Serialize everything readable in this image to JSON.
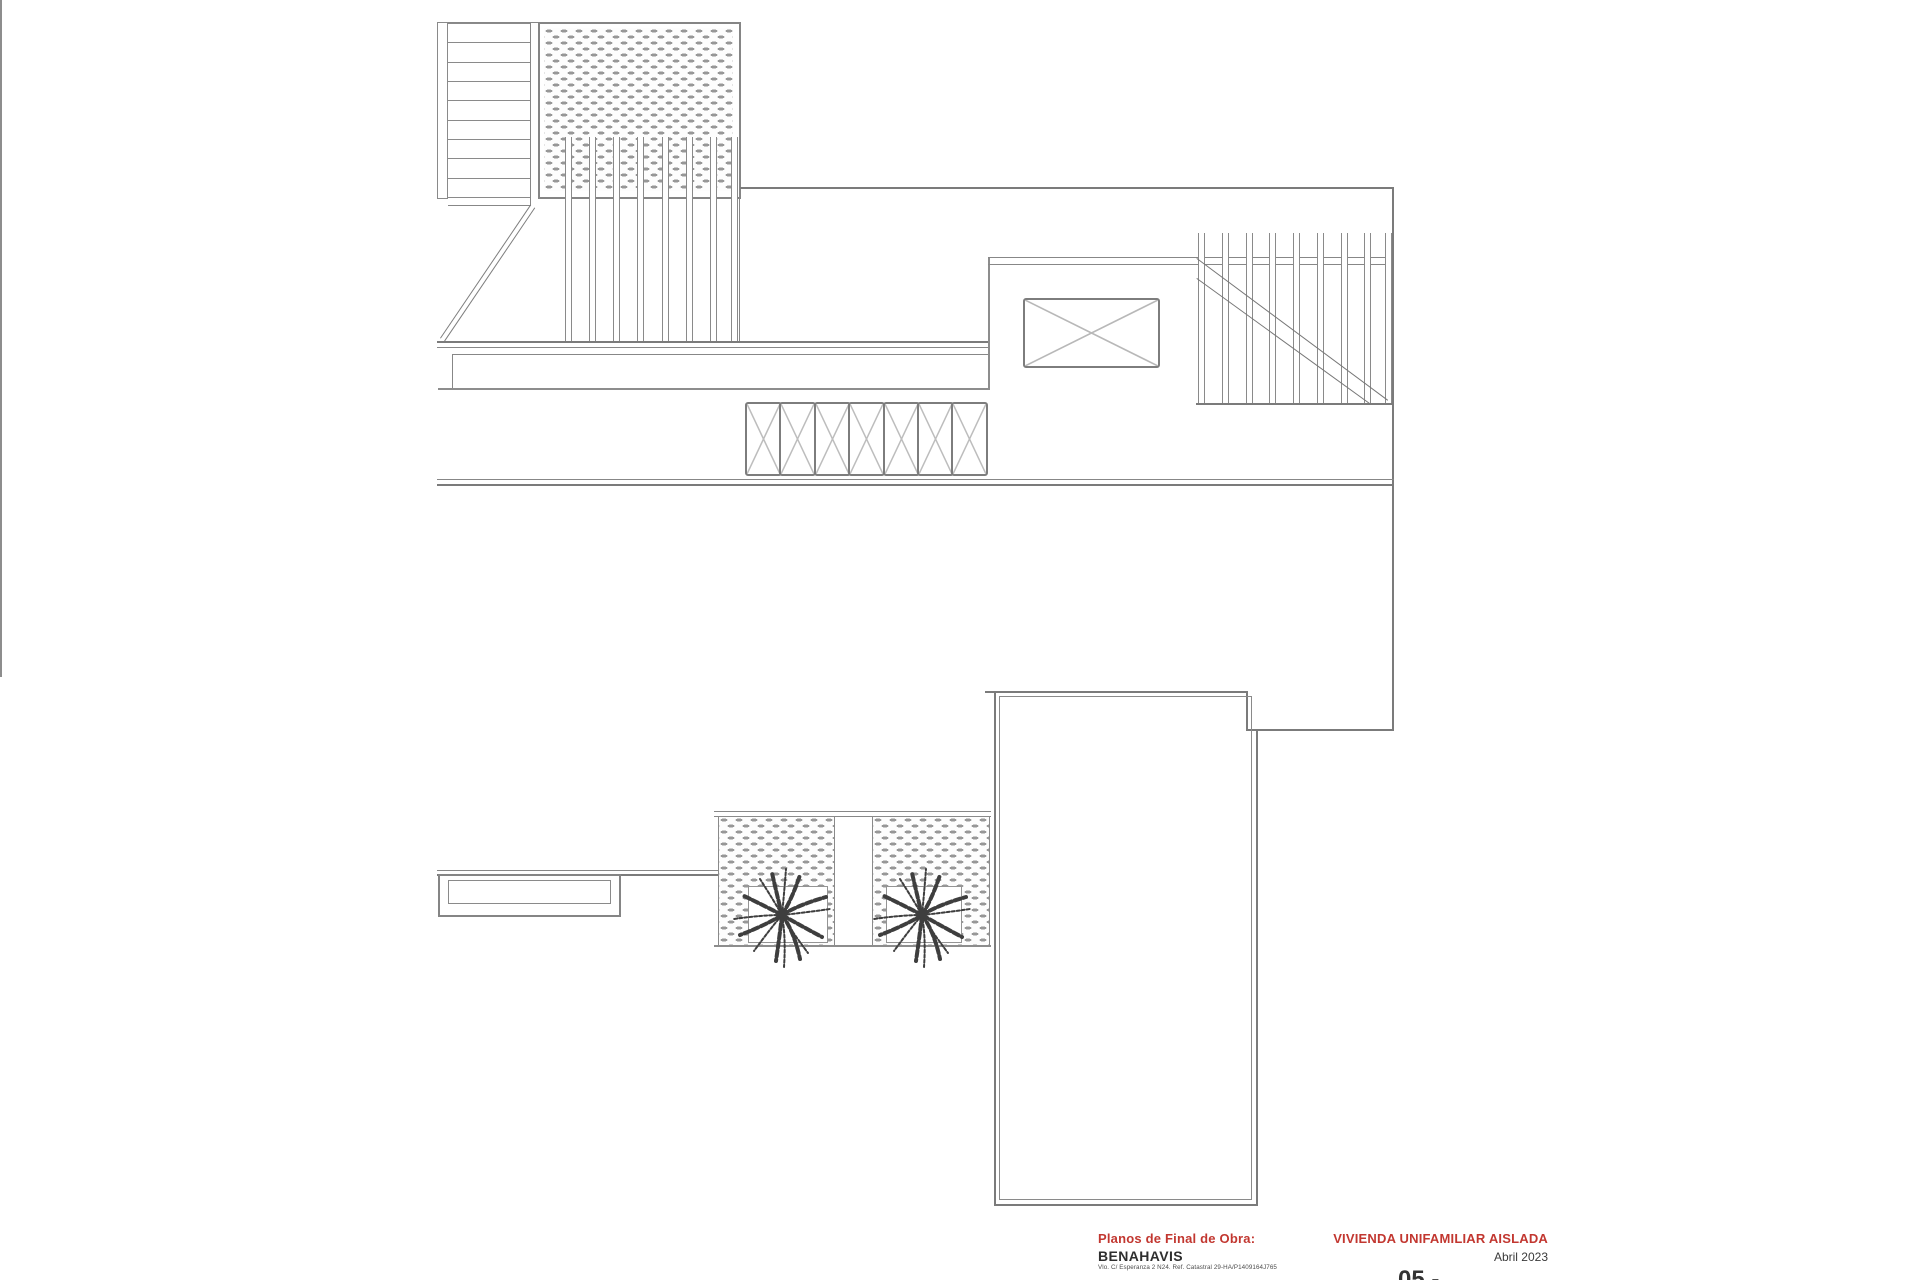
{
  "title_block": {
    "doc_type_label": "Planos de Final de Obra:",
    "project_label": "VIVIENDA UNIFAMILIAR AISLADA",
    "location": "BENAHAVIS",
    "address_line": "Vlo. C/ Esperanza 2 N24. Ref. Catastral 29-HA/P1409164J765",
    "date": "Abril 2023",
    "sheet_number": "05 -"
  },
  "colors": {
    "accent_red": "#c23730",
    "line_gray": "#878787",
    "palm_gray": "#3e3e3e"
  },
  "plan_features": [
    "staircase-top-left",
    "hatched-deck-top",
    "pergola-slats-left",
    "pergola-slats-right-with-stair-diagonals",
    "skylight-x-rectangle",
    "roof-beam-x-boxes-row",
    "main-flat-roof",
    "lower-right-roof-volume",
    "twin-planters-with-palms",
    "terrace-steps-bottom-left"
  ]
}
